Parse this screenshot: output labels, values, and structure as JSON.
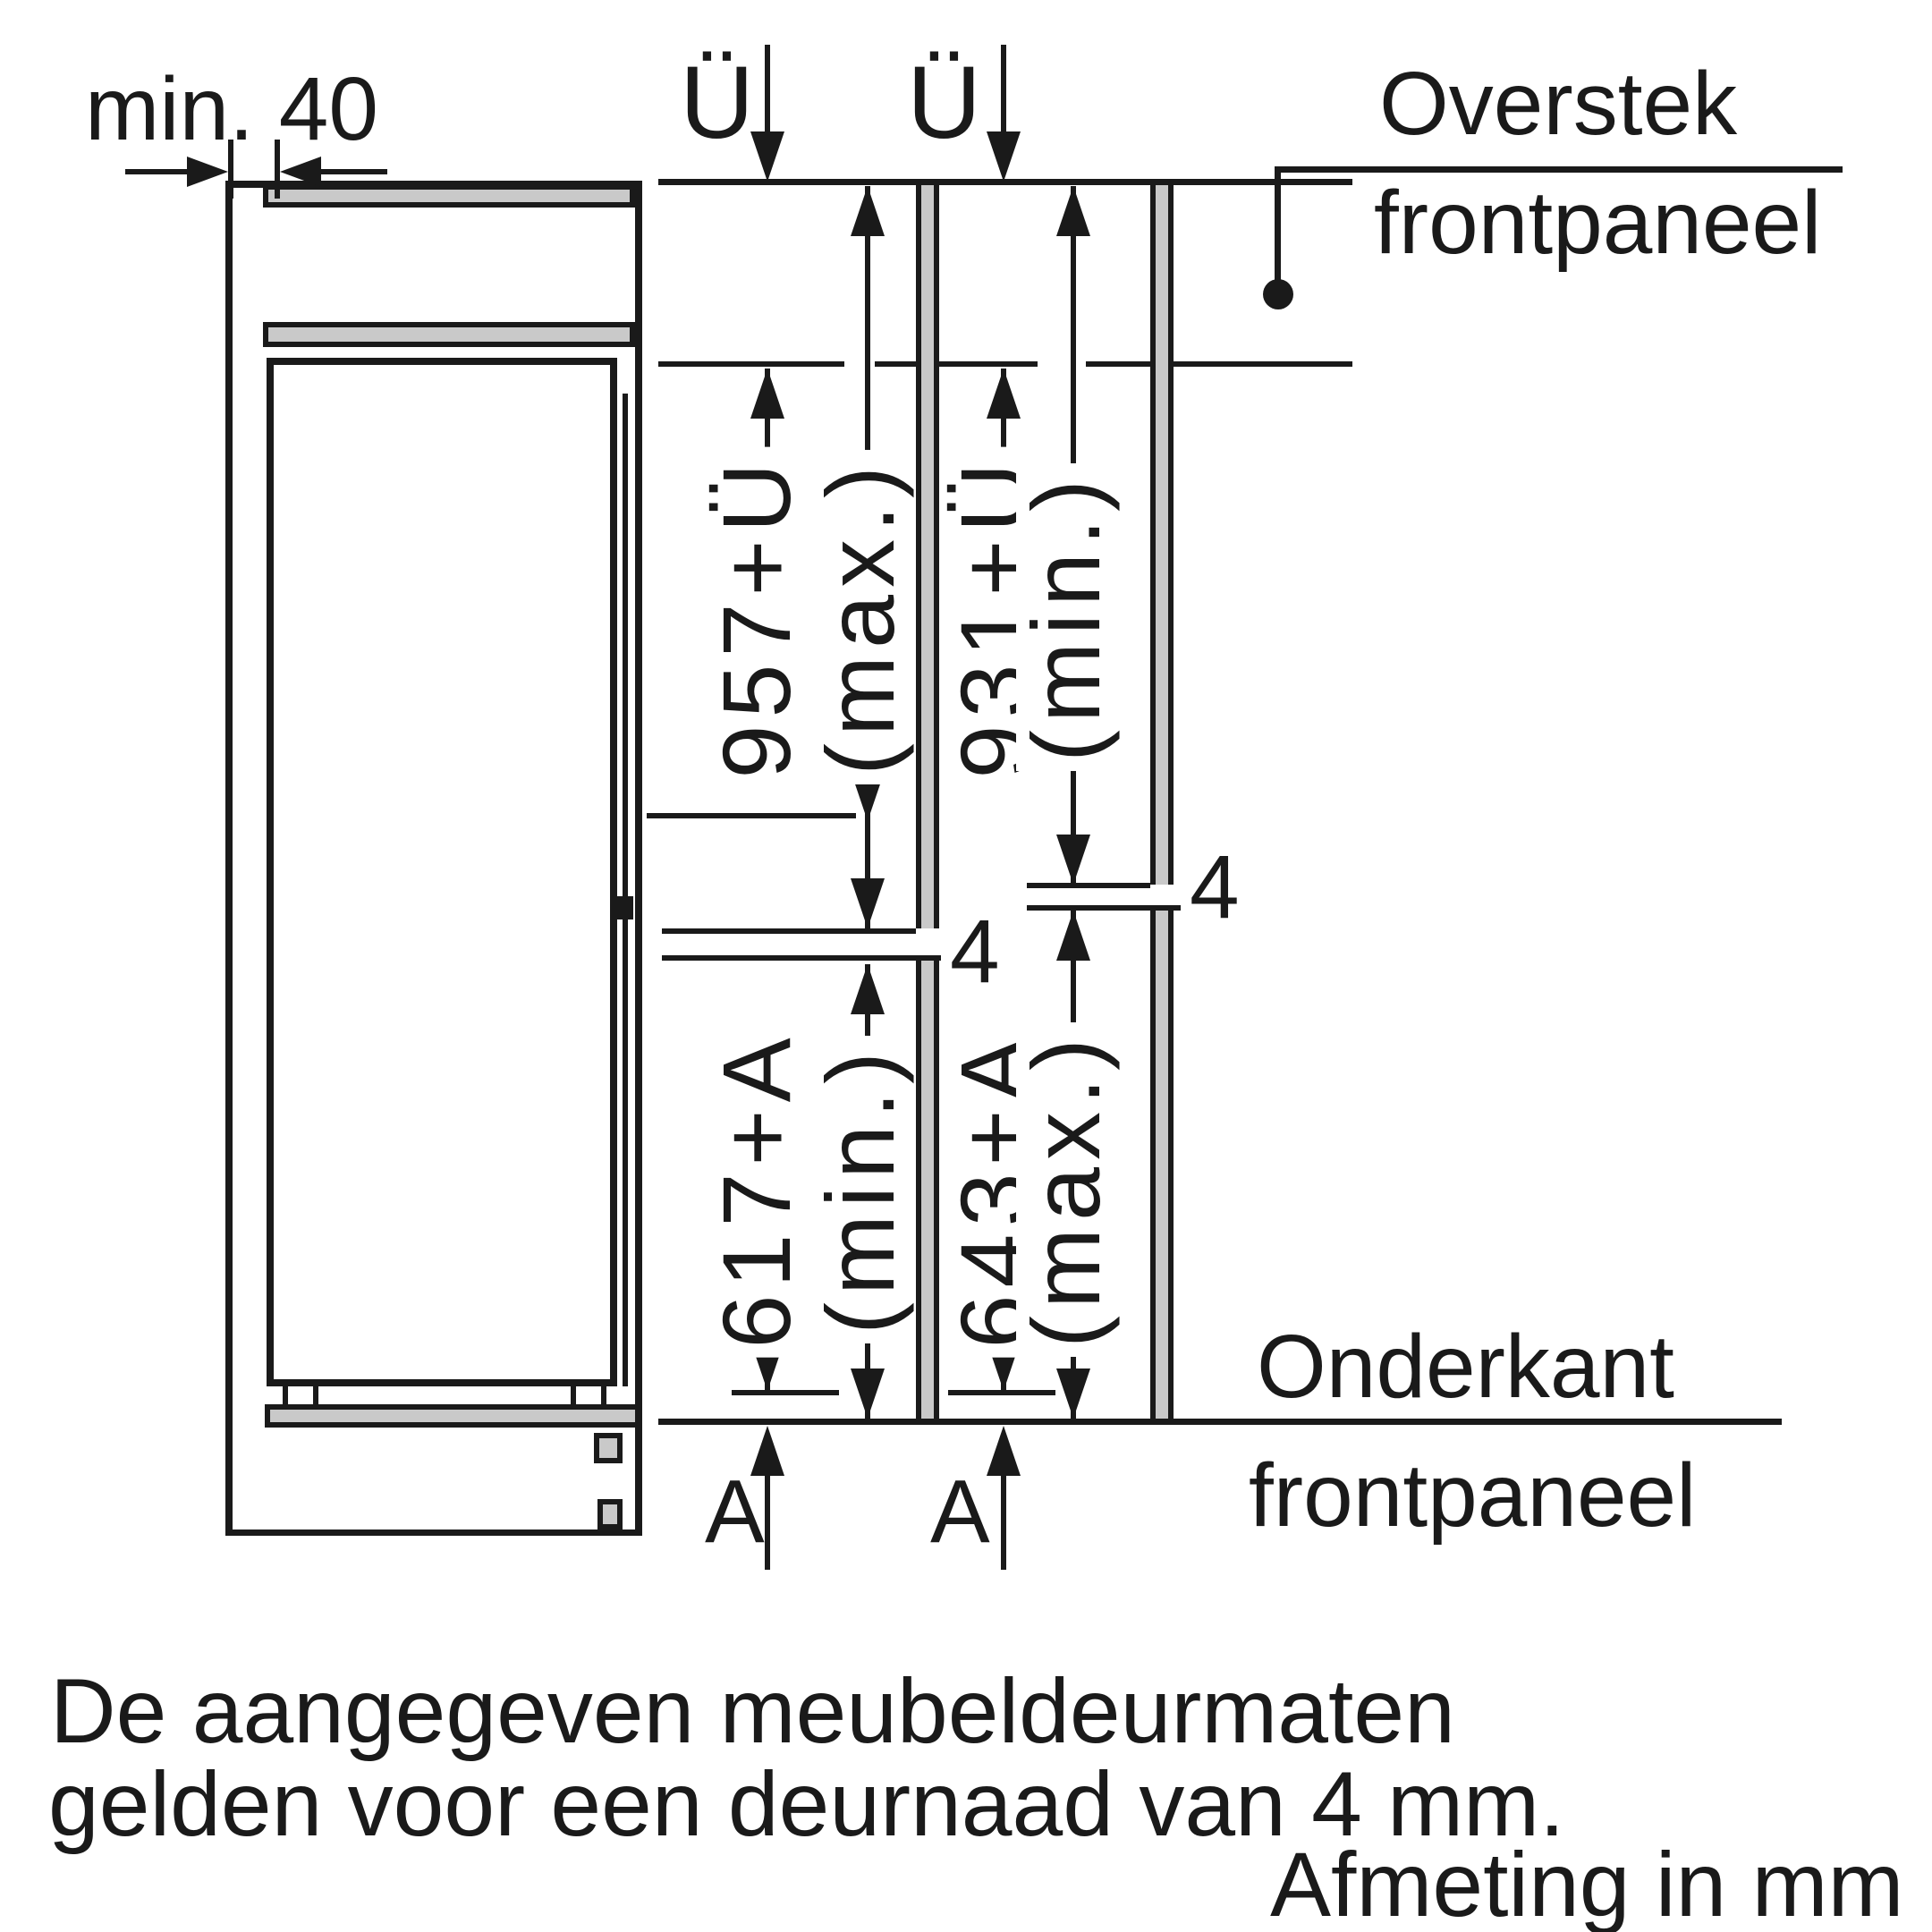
{
  "colors": {
    "ink": "#1a1a1a",
    "panel": "#c9c9c9",
    "bg": "#ffffff"
  },
  "dim_min40": {
    "label": "min. 40"
  },
  "overhang": {
    "symbol": "Ü"
  },
  "bottom_adjust": {
    "symbol": "A"
  },
  "door_gap": {
    "value": "4"
  },
  "callouts": {
    "overstek_line1": "Overstek",
    "overstek_line2": "frontpaneel",
    "onderkant_line1": "Onderkant",
    "onderkant_line2": "frontpaneel"
  },
  "door_dimensions": {
    "upper_max": "957+Ü",
    "upper_max_qualifier": "(max.)",
    "upper_min": "931+Ü",
    "upper_min_qualifier": "(min.)",
    "lower_min": "617+A",
    "lower_min_qualifier": "(min.)",
    "lower_max": "643+A",
    "lower_max_qualifier": "(max.)"
  },
  "notes": {
    "line1": "De aangegeven meubeldeurmaten",
    "line2": "gelden voor een deurnaad van 4 mm.",
    "units": "Afmeting in mm"
  }
}
